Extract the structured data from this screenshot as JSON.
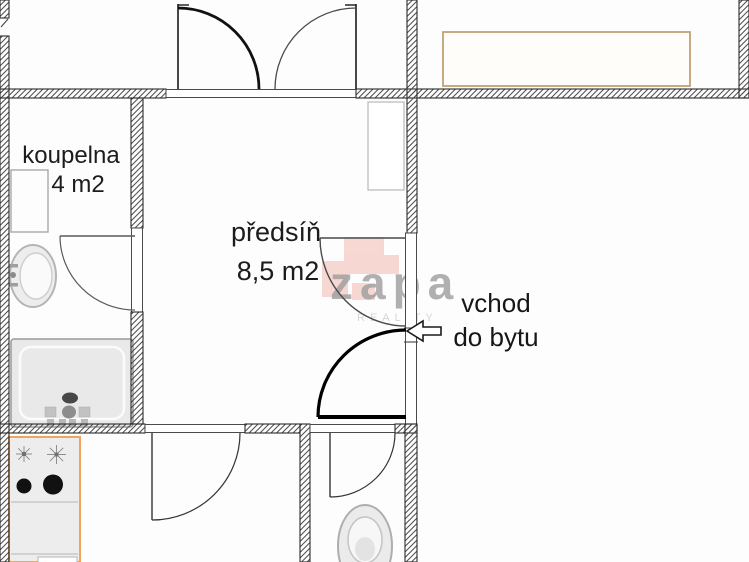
{
  "rooms": {
    "bathroom": {
      "name": "koupelna",
      "area": "4 m2"
    },
    "hall": {
      "name": "předsíň",
      "area": "8,5 m2"
    }
  },
  "entrance": {
    "label_line1": "vchod",
    "label_line2": "do bytu"
  },
  "watermark": {
    "brand": "zapa",
    "tagline": "REALITY"
  },
  "colors": {
    "wall_outline": "#2b2b2b",
    "furniture_orange": "#f2a55a",
    "furniture_tan": "#c1a176",
    "watermark_gray": "#9b9b9b",
    "watermark_pink": "#efab9f"
  }
}
